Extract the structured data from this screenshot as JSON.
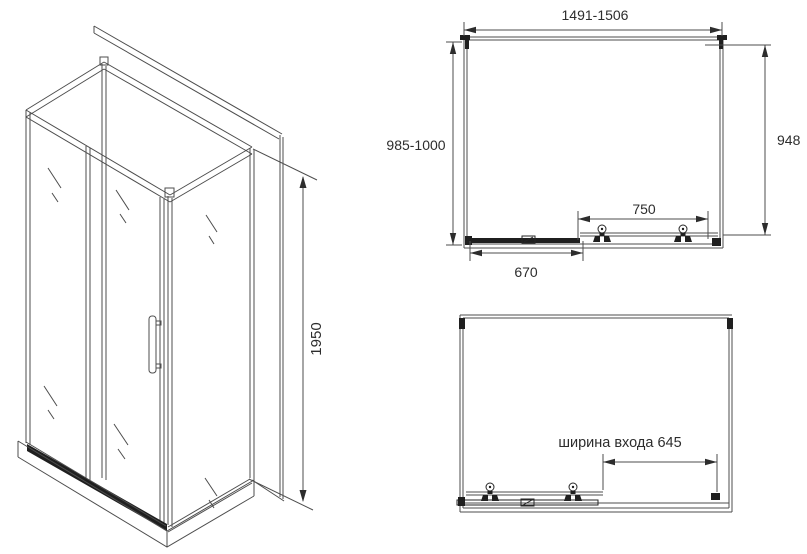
{
  "page": {
    "type": "technical drawing of shower enclosure",
    "background": "#ffffff"
  },
  "views": {
    "isometric": {
      "name": "shower cabin isometric view",
      "dims": {
        "height": "1950"
      }
    },
    "plan_top": {
      "name": "upper plan view",
      "dims": {
        "width_range": "1491-1506",
        "depth_range": "985-1000",
        "side_width": "948",
        "door_width": "750",
        "fixed_width": "670"
      }
    },
    "plan_bottom": {
      "name": "lower plan view with entrance",
      "dims": {
        "entrance_width": "ширина входа 645"
      }
    }
  },
  "colors": {
    "line": "#4d4d4d",
    "dark": "#1f1f1f",
    "text": "#2d2d2d",
    "background": "#ffffff"
  }
}
